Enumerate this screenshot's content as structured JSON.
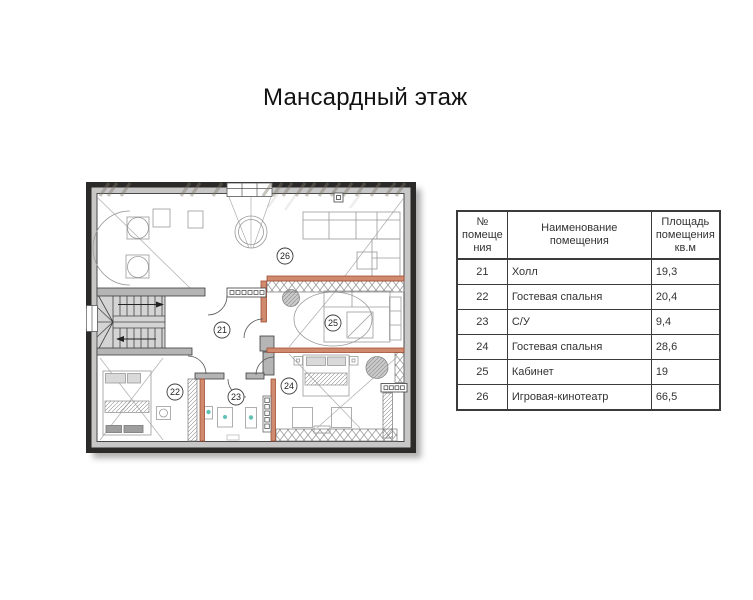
{
  "page": {
    "title": "Мансардный этаж"
  },
  "floor_plan": {
    "room_labels": [
      {
        "number": "21",
        "x": 222,
        "y": 330
      },
      {
        "number": "22",
        "x": 175,
        "y": 392
      },
      {
        "number": "23",
        "x": 236,
        "y": 397
      },
      {
        "number": "24",
        "x": 289,
        "y": 386
      },
      {
        "number": "25",
        "x": 333,
        "y": 323
      },
      {
        "number": "26",
        "x": 285,
        "y": 256
      }
    ],
    "colors": {
      "outer_wall": "#2b2a28",
      "wall_band": "#c7c7c7",
      "interior_wall": "#b5b5b5",
      "partition_fill": "#d08a6e",
      "partition_edge": "#a14f35",
      "fixture_accent_teal": "#63c1b5",
      "stair_fill": "#d4d4d4",
      "furniture_line": "#9a9a9a"
    }
  },
  "table": {
    "headers": {
      "number": "№\nпомеще\nния",
      "name": "Наименование помещения",
      "area": "Площадь\nпомещения\nкв.м"
    },
    "rows": [
      {
        "number": "21",
        "name": "Холл",
        "area": "19,3"
      },
      {
        "number": "22",
        "name": "Гостевая спальня",
        "area": "20,4"
      },
      {
        "number": "23",
        "name": "С/У",
        "area": "9,4"
      },
      {
        "number": "24",
        "name": "Гостевая спальня",
        "area": "28,6"
      },
      {
        "number": "25",
        "name": "Кабинет",
        "area": "19"
      },
      {
        "number": "26",
        "name": "Игровая-кинотеатр",
        "area": "66,5"
      }
    ]
  }
}
